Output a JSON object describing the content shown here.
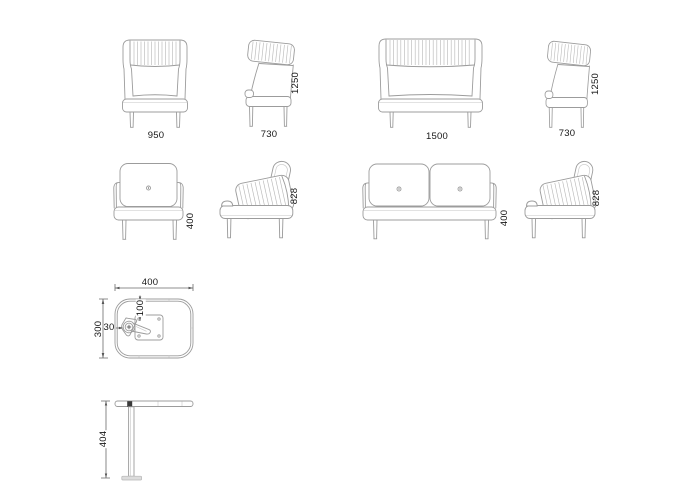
{
  "page": {
    "background": "#ffffff"
  },
  "colors": {
    "line": "#9c9c9c",
    "hatch": "#bababa",
    "dim": "#6a6a6a",
    "arrow": "#555555",
    "text": "#161616",
    "base_fill": "#dcdcdc",
    "clamp_fill": "#3a3a3a"
  },
  "views": {
    "high_back_chair": {
      "front_width": "950",
      "side_depth": "730",
      "side_height": "1250"
    },
    "high_back_sofa": {
      "front_width": "1500",
      "side_depth": "730",
      "side_height": "1250"
    },
    "low_back_chair": {
      "seat_height": "400",
      "back_height": "828"
    },
    "low_back_sofa": {
      "seat_height": "400",
      "back_height": "828"
    },
    "side_table": {
      "top_width": "400",
      "top_depth": "300",
      "clamp_offset": "30",
      "plate_inset": "100",
      "height": "404"
    }
  }
}
